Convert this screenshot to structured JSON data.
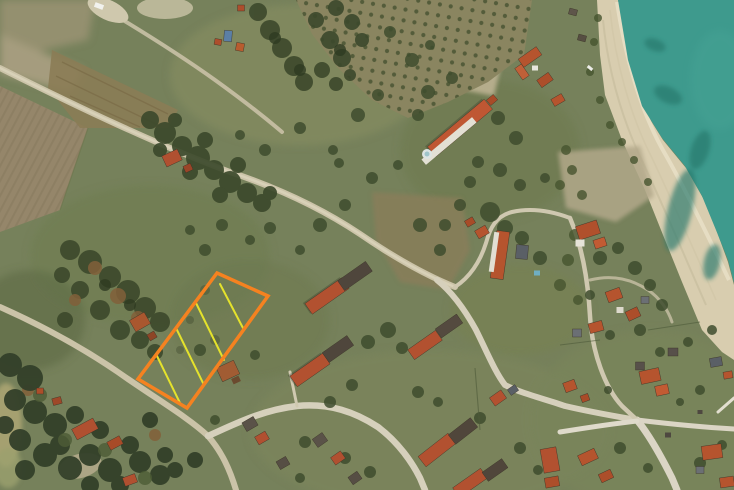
{
  "map": {
    "title": "satellite-map",
    "scene": "aerial photo of coastal village with beach, sea, fields and highlighted land parcel",
    "palette": {
      "land": "#76815B",
      "sea": "#3E9A8D",
      "sand": "#D8CDAF",
      "road": "#CCC4A9",
      "road_light": "#DCD6C6",
      "forest": "#3C492C",
      "roof_red": "#B5542E",
      "roof_dark": "#52483D"
    }
  },
  "parcel": {
    "outline_color": "#F58220",
    "outline_width": 3.5,
    "hatch_color": "#E4E22C",
    "hatch_width": 2,
    "points": "217,273 268,296 187,408 138,379",
    "hatch_lines": [
      [
        220,
        284,
        244,
        330
      ],
      [
        196,
        303,
        224,
        360
      ],
      [
        176,
        328,
        204,
        385
      ],
      [
        156,
        354,
        180,
        403
      ]
    ]
  }
}
